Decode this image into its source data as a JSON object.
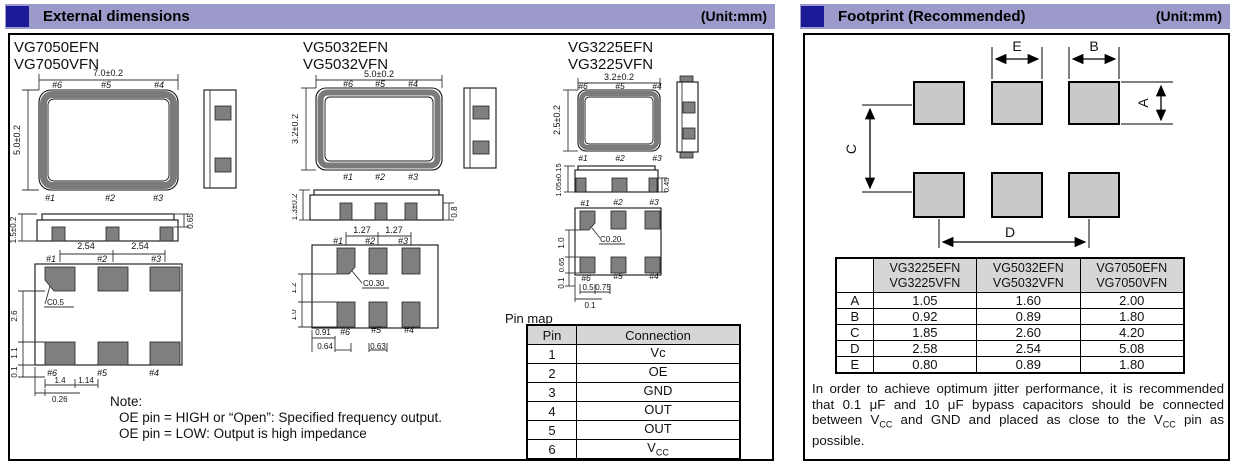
{
  "colors": {
    "header_bg": "#9b9aca",
    "header_square": "#1b1a96",
    "pad_dark": "#7f7f7f",
    "pad_light": "#c9c9c9",
    "table_header_bg": "#d6d6d6"
  },
  "left_panel": {
    "title": "External dimensions",
    "unit": "(Unit:mm)",
    "packages": [
      {
        "name1": "VG7050EFN",
        "name2": "VG7050VFN",
        "dim_width": "7.0±0.2",
        "dim_height": "5.0±0.2",
        "dim_profile": "1.5±0.2",
        "dim_lid": "0.65",
        "pins_top": [
          "#6",
          "#5",
          "#4"
        ],
        "pins_bottom": [
          "#1",
          "#2",
          "#3"
        ],
        "pitch1": "2.54",
        "pitch2": "2.54",
        "chamfer": "C0.5",
        "v1": "2.6",
        "v2": "1.1",
        "v3": "0.1",
        "b1": "1.4",
        "b2": "1.14",
        "b3": "0.26"
      },
      {
        "name1": "VG5032EFN",
        "name2": "VG5032VFN",
        "dim_width": "5.0±0.2",
        "dim_height": "3.2±0.2",
        "dim_profile": "1.3±0.2",
        "dim_lid": "0.8",
        "pins_top": [
          "#6",
          "#5",
          "#4"
        ],
        "pins_bottom": [
          "#1",
          "#2",
          "#3"
        ],
        "pitch1": "1.27",
        "pitch2": "1.27",
        "chamfer": "C0.30",
        "v1": "1.2",
        "v2": "1.0",
        "b1": "0.91",
        "b2": "0.64",
        "b3": "0.63"
      },
      {
        "name1": "VG3225EFN",
        "name2": "VG3225VFN",
        "dim_width": "3.2±0.2",
        "dim_height": "2.5±0.2",
        "dim_profile": "1.05±0.15",
        "dim_lid": "0.45",
        "pins_top": [
          "#6",
          "#5",
          "#4"
        ],
        "pins_bottom": [
          "#1",
          "#2",
          "#3"
        ],
        "chamfer": "C0.20",
        "v1": "1.0",
        "v2": "0.65",
        "v3": "0.1",
        "b1": "0.5",
        "b2": "0.75",
        "b3": "0.1"
      }
    ],
    "pin_map": {
      "title": "Pin map",
      "col_pin": "Pin",
      "col_conn": "Connection",
      "rows": [
        {
          "pin": "1",
          "conn": "Vc",
          "sub": ""
        },
        {
          "pin": "2",
          "conn": "OE",
          "sub": ""
        },
        {
          "pin": "3",
          "conn": "GND",
          "sub": ""
        },
        {
          "pin": "4",
          "conn": "OUT",
          "sub": ""
        },
        {
          "pin": "5",
          "conn": "OUT",
          "sub": ""
        },
        {
          "pin": "6",
          "conn": "V",
          "sub": "CC"
        }
      ]
    },
    "note": {
      "label": "Note:",
      "line1": "OE pin = HIGH or “Open”: Specified frequency output.",
      "line2": "OE pin = LOW: Output is high impedance"
    }
  },
  "right_panel": {
    "title": "Footprint (Recommended)",
    "unit": "(Unit:mm)",
    "diagram": {
      "label_a": "A",
      "label_b": "B",
      "label_c": "C",
      "label_d": "D",
      "label_e": "E"
    },
    "table": {
      "headers": [
        {
          "line1": "VG3225EFN",
          "line2": "VG3225VFN"
        },
        {
          "line1": "VG5032EFN",
          "line2": "VG5032VFN"
        },
        {
          "line1": "VG7050EFN",
          "line2": "VG7050VFN"
        }
      ],
      "rows": [
        {
          "label": "A",
          "v1": "1.05",
          "v2": "1.60",
          "v3": "2.00"
        },
        {
          "label": "B",
          "v1": "0.92",
          "v2": "0.89",
          "v3": "1.80"
        },
        {
          "label": "C",
          "v1": "1.85",
          "v2": "2.60",
          "v3": "4.20"
        },
        {
          "label": "D",
          "v1": "2.58",
          "v2": "2.54",
          "v3": "5.08"
        },
        {
          "label": "E",
          "v1": "0.80",
          "v2": "0.89",
          "v3": "1.80"
        }
      ]
    },
    "note": {
      "p1": "In order to achieve optimum jitter performance, it is recommended that 0.1 μF and 10 μF bypass capacitors should be connected between V",
      "s1": "CC",
      "p2": " and GND and placed as close to the V",
      "s2": "CC",
      "p3": " pin as possible."
    }
  }
}
